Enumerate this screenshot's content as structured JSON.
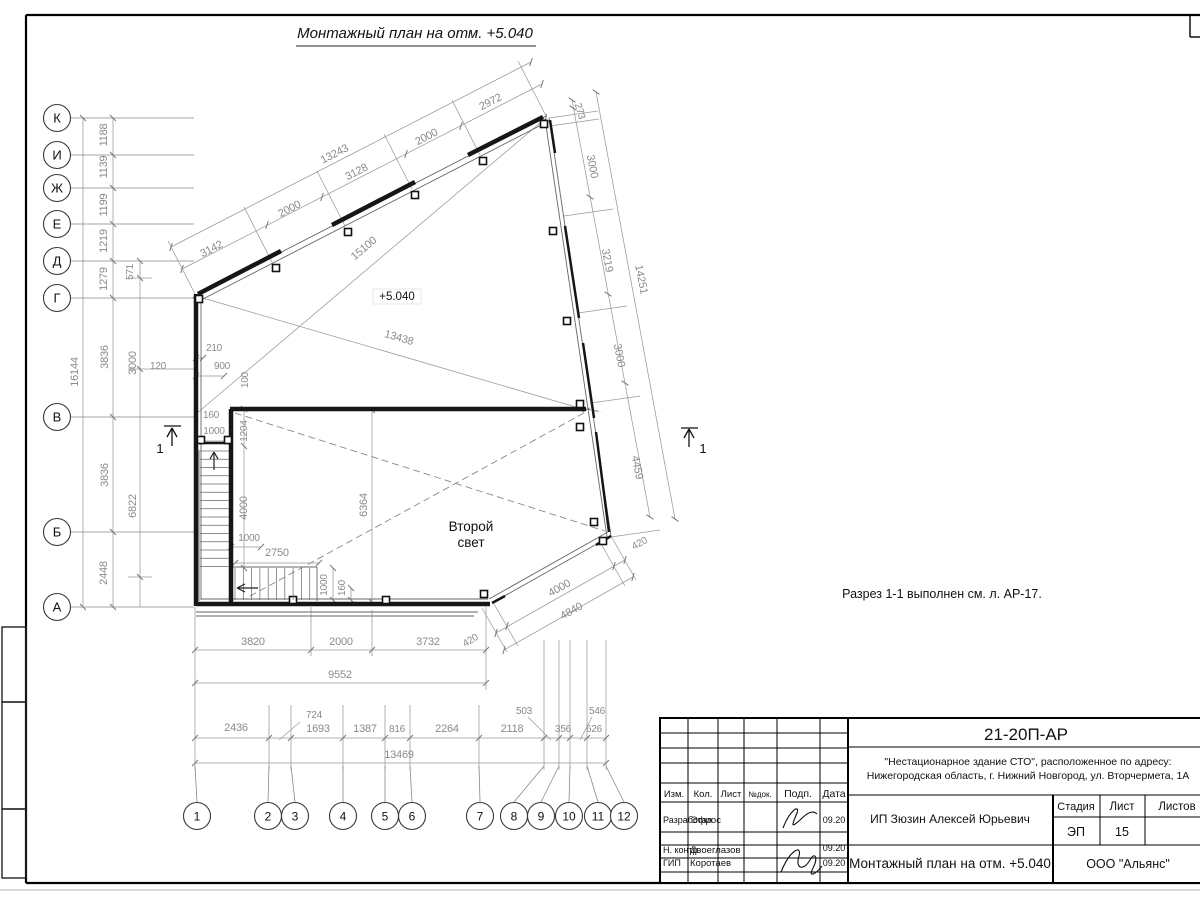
{
  "sheet": {
    "title": "Монтажный план на отм. +5.040",
    "note": "Разрез 1-1 выполнен см. л. АР-17.",
    "elevation_label": "+5.040",
    "room_label": "Второй свет"
  },
  "section_marks": [
    {
      "label": "1",
      "side": "left"
    },
    {
      "label": "1",
      "side": "right"
    }
  ],
  "axes": {
    "left": [
      {
        "label": "К",
        "y": 118
      },
      {
        "label": "И",
        "y": 155
      },
      {
        "label": "Ж",
        "y": 188
      },
      {
        "label": "Е",
        "y": 224
      },
      {
        "label": "Д",
        "y": 261
      },
      {
        "label": "Г",
        "y": 298
      },
      {
        "label": "В",
        "y": 417
      },
      {
        "label": "Б",
        "y": 532
      },
      {
        "label": "А",
        "y": 607
      }
    ],
    "bottom": [
      {
        "label": "1",
        "x": 197
      },
      {
        "label": "2",
        "x": 268
      },
      {
        "label": "3",
        "x": 295
      },
      {
        "label": "4",
        "x": 343
      },
      {
        "label": "5",
        "x": 385
      },
      {
        "label": "6",
        "x": 412
      },
      {
        "label": "7",
        "x": 480
      },
      {
        "label": "8",
        "x": 514
      },
      {
        "label": "9",
        "x": 541
      },
      {
        "label": "10",
        "x": 569
      },
      {
        "label": "11",
        "x": 598
      },
      {
        "label": "12",
        "x": 624
      }
    ]
  },
  "dim_labels": [
    {
      "t": "3142",
      "x": 213,
      "y": 252,
      "r": -27
    },
    {
      "t": "2000",
      "x": 291,
      "y": 212,
      "r": -27
    },
    {
      "t": "3128",
      "x": 358,
      "y": 175,
      "r": -27
    },
    {
      "t": "2000",
      "x": 428,
      "y": 140,
      "r": -27
    },
    {
      "t": "2972",
      "x": 492,
      "y": 105,
      "r": -27
    },
    {
      "t": "13243",
      "x": 336,
      "y": 157,
      "r": -27
    },
    {
      "t": "15100",
      "x": 366,
      "y": 251,
      "r": -40
    },
    {
      "t": "13438",
      "x": 398,
      "y": 341,
      "r": 16
    },
    {
      "t": "273",
      "x": 577,
      "y": 112,
      "r": 73,
      "s": 10
    },
    {
      "t": "3000",
      "x": 589,
      "y": 167,
      "r": 79
    },
    {
      "t": "3219",
      "x": 604,
      "y": 261,
      "r": 79
    },
    {
      "t": "14251",
      "x": 638,
      "y": 280,
      "r": 79
    },
    {
      "t": "3000",
      "x": 616,
      "y": 356,
      "r": 79
    },
    {
      "t": "4459",
      "x": 634,
      "y": 468,
      "r": 79
    },
    {
      "t": "420",
      "x": 641,
      "y": 546,
      "r": -29,
      "s": 10
    },
    {
      "t": "4000",
      "x": 561,
      "y": 591,
      "r": -29
    },
    {
      "t": "4840",
      "x": 573,
      "y": 614,
      "r": -29
    },
    {
      "t": "1188",
      "x": 107,
      "y": 135,
      "r": -90
    },
    {
      "t": "1139",
      "x": 107,
      "y": 167,
      "r": -90
    },
    {
      "t": "1199",
      "x": 107,
      "y": 205,
      "r": -90
    },
    {
      "t": "1219",
      "x": 107,
      "y": 241,
      "r": -90
    },
    {
      "t": "1279",
      "x": 107,
      "y": 279,
      "r": -90
    },
    {
      "t": "571",
      "x": 133,
      "y": 272,
      "r": -90,
      "s": 10
    },
    {
      "t": "16144",
      "x": 78,
      "y": 372,
      "r": -90
    },
    {
      "t": "3836",
      "x": 108,
      "y": 357,
      "r": -90
    },
    {
      "t": "3000",
      "x": 136,
      "y": 363,
      "r": -90
    },
    {
      "t": "120",
      "x": 158,
      "y": 369,
      "r": 0,
      "s": 10
    },
    {
      "t": "3836",
      "x": 108,
      "y": 475,
      "r": -90
    },
    {
      "t": "6822",
      "x": 136,
      "y": 506,
      "r": -90
    },
    {
      "t": "2448",
      "x": 107,
      "y": 573,
      "r": -90
    },
    {
      "t": "210",
      "x": 214,
      "y": 351,
      "r": 0,
      "s": 10
    },
    {
      "t": "900",
      "x": 222,
      "y": 369,
      "r": 0,
      "s": 10
    },
    {
      "t": "100",
      "x": 248,
      "y": 380,
      "r": -90,
      "s": 10
    },
    {
      "t": "160",
      "x": 211,
      "y": 418,
      "r": 0,
      "s": 10
    },
    {
      "t": "1000",
      "x": 214,
      "y": 434,
      "r": 0,
      "s": 10
    },
    {
      "t": "1204",
      "x": 247,
      "y": 431,
      "r": -90,
      "s": 10
    },
    {
      "t": "4000",
      "x": 247,
      "y": 508,
      "r": -90
    },
    {
      "t": "1000",
      "x": 249,
      "y": 541,
      "r": 0,
      "s": 10
    },
    {
      "t": "2750",
      "x": 277,
      "y": 556,
      "r": 0
    },
    {
      "t": "1000",
      "x": 327,
      "y": 585,
      "r": -90,
      "s": 10
    },
    {
      "t": "160",
      "x": 345,
      "y": 588,
      "r": -90,
      "s": 10
    },
    {
      "t": "6364",
      "x": 367,
      "y": 505,
      "r": -90
    },
    {
      "t": "3820",
      "x": 253,
      "y": 645,
      "r": 0
    },
    {
      "t": "2000",
      "x": 341,
      "y": 645,
      "r": 0
    },
    {
      "t": "3732",
      "x": 428,
      "y": 645,
      "r": 0
    },
    {
      "t": "420",
      "x": 472,
      "y": 643,
      "r": -31,
      "s": 10
    },
    {
      "t": "9552",
      "x": 340,
      "y": 678,
      "r": 0
    },
    {
      "t": "2436",
      "x": 236,
      "y": 731,
      "r": 0
    },
    {
      "t": "724",
      "x": 314,
      "y": 718,
      "r": 0,
      "s": 10
    },
    {
      "t": "1693",
      "x": 318,
      "y": 732,
      "r": 0
    },
    {
      "t": "1387",
      "x": 365,
      "y": 732,
      "r": 0
    },
    {
      "t": "816",
      "x": 397,
      "y": 732,
      "r": 0,
      "s": 10
    },
    {
      "t": "2264",
      "x": 447,
      "y": 732,
      "r": 0
    },
    {
      "t": "2118",
      "x": 512,
      "y": 732,
      "r": 0
    },
    {
      "t": "503",
      "x": 524,
      "y": 714,
      "r": 0,
      "s": 10
    },
    {
      "t": "356",
      "x": 563,
      "y": 732,
      "r": 0,
      "s": 10
    },
    {
      "t": "546",
      "x": 597,
      "y": 714,
      "r": 0,
      "s": 10
    },
    {
      "t": "626",
      "x": 594,
      "y": 732,
      "r": 0,
      "s": 10
    },
    {
      "t": "13469",
      "x": 399,
      "y": 758,
      "r": 0
    }
  ],
  "titleblock": {
    "doc_number": "21-20П-АР",
    "project_line1": "\"Нестационарное здание СТО\", расположенное по адресу:",
    "project_line2": "Нижегородская область, г. Нижний Новгород, ул. Вторчермета, 1А",
    "client": "ИП Зюзин Алексей Юрьевич",
    "sheet_title": "Монтажный план на отм. +5.040",
    "company": "ООО \"Альянс\"",
    "stage_header": "Стадия",
    "sheet_header": "Лист",
    "sheets_header": "Листов",
    "stage": "ЭП",
    "sheet_no": "15",
    "header_cols": [
      "Изм.",
      "Кол.",
      "Лист",
      "№док.",
      "Подп.",
      "Дата"
    ],
    "rows": [
      {
        "role": "Разработал",
        "name": "Эфрос",
        "date": "09.20"
      },
      {
        "role": "Н. контр.",
        "name": "Двоеглазов",
        "date": "09.20"
      },
      {
        "role": "ГИП",
        "name": "Коротаев",
        "date": "09.20"
      }
    ]
  }
}
